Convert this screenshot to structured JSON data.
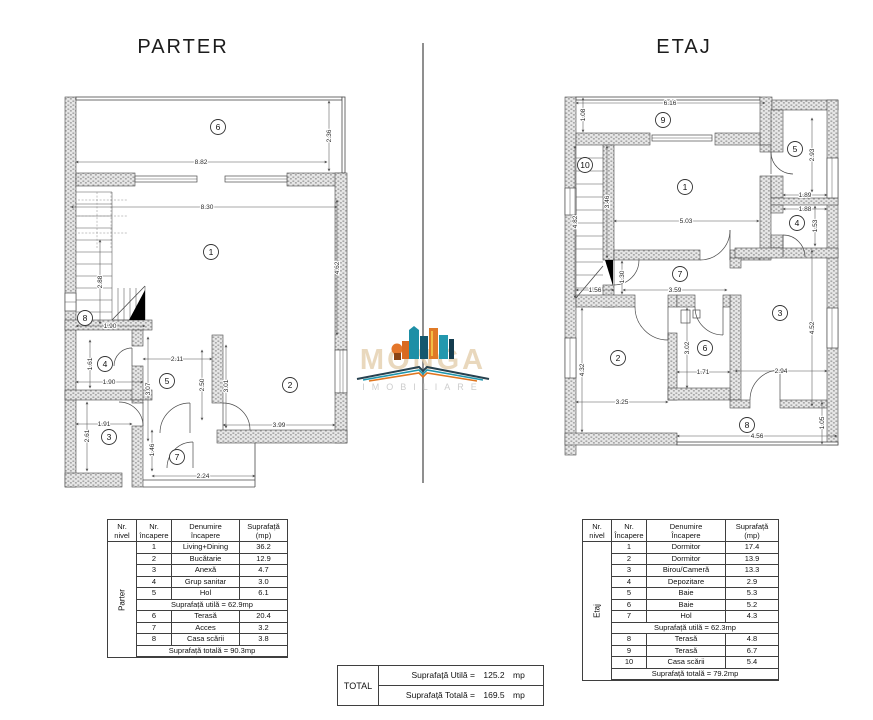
{
  "titles": {
    "left": "PARTER",
    "right": "ETAJ"
  },
  "watermark": {
    "name": "MONGA",
    "tagline": "IMOBILIARE"
  },
  "colors": {
    "accent_orange": "#e0751f",
    "accent_teal": "#1f96ad",
    "accent_navy": "#27414f",
    "wall_fill": "#e7e7e7",
    "wall_dot": "#9a9a9a",
    "line": "#4a4a4a",
    "divider": "#8f8f8f"
  },
  "plans": {
    "parter": {
      "rooms": [
        {
          "n": "6",
          "x": 161,
          "y": 39
        },
        {
          "n": "1",
          "x": 154,
          "y": 164
        },
        {
          "n": "8",
          "x": 28,
          "y": 230
        },
        {
          "n": "4",
          "x": 48,
          "y": 276
        },
        {
          "n": "5",
          "x": 110,
          "y": 293
        },
        {
          "n": "3",
          "x": 52,
          "y": 349
        },
        {
          "n": "7",
          "x": 120,
          "y": 369
        },
        {
          "n": "2",
          "x": 233,
          "y": 297
        }
      ],
      "dims": [
        {
          "v": "8.82",
          "x": 144,
          "y": 76
        },
        {
          "v": "2.36",
          "x": 274,
          "y": 48,
          "r": 1
        },
        {
          "v": "8.30",
          "x": 150,
          "y": 121
        },
        {
          "v": "4.62",
          "x": 282,
          "y": 180,
          "r": 1
        },
        {
          "v": "2.88",
          "x": 45,
          "y": 194,
          "r": 1
        },
        {
          "v": "1.90",
          "x": 53,
          "y": 240
        },
        {
          "v": "1.61",
          "x": 35,
          "y": 276,
          "r": 1
        },
        {
          "v": "1.90",
          "x": 52,
          "y": 296
        },
        {
          "v": "2.11",
          "x": 120,
          "y": 273
        },
        {
          "v": "3.07",
          "x": 93,
          "y": 301,
          "r": 1
        },
        {
          "v": "2.50",
          "x": 147,
          "y": 297,
          "r": 1
        },
        {
          "v": "1.91",
          "x": 47,
          "y": 338
        },
        {
          "v": "2.61",
          "x": 32,
          "y": 348,
          "r": 1
        },
        {
          "v": "1.46",
          "x": 97,
          "y": 362,
          "r": 1
        },
        {
          "v": "2.24",
          "x": 146,
          "y": 390
        },
        {
          "v": "3.99",
          "x": 222,
          "y": 339
        },
        {
          "v": "3.01",
          "x": 171,
          "y": 298,
          "r": 1
        }
      ]
    },
    "etaj": {
      "rooms": [
        {
          "n": "9",
          "x": 108,
          "y": 32
        },
        {
          "n": "10",
          "x": 30,
          "y": 77
        },
        {
          "n": "1",
          "x": 130,
          "y": 99
        },
        {
          "n": "5",
          "x": 240,
          "y": 61
        },
        {
          "n": "4",
          "x": 242,
          "y": 135
        },
        {
          "n": "7",
          "x": 125,
          "y": 186
        },
        {
          "n": "2",
          "x": 63,
          "y": 270
        },
        {
          "n": "6",
          "x": 150,
          "y": 260
        },
        {
          "n": "3",
          "x": 225,
          "y": 225
        },
        {
          "n": "8",
          "x": 192,
          "y": 337
        }
      ],
      "dims": [
        {
          "v": "6.16",
          "x": 115,
          "y": 17
        },
        {
          "v": "1.08",
          "x": 30,
          "y": 27,
          "r": 1
        },
        {
          "v": "4.82",
          "x": 22,
          "y": 134,
          "r": 1
        },
        {
          "v": "3.46",
          "x": 54,
          "y": 114,
          "r": 1
        },
        {
          "v": "5.03",
          "x": 131,
          "y": 135
        },
        {
          "v": "2.93",
          "x": 259,
          "y": 67,
          "r": 1
        },
        {
          "v": "1.89",
          "x": 250,
          "y": 109
        },
        {
          "v": "1.88",
          "x": 250,
          "y": 123
        },
        {
          "v": "1.53",
          "x": 262,
          "y": 138,
          "r": 1
        },
        {
          "v": "1.30",
          "x": 69,
          "y": 189,
          "r": 1
        },
        {
          "v": "1.56",
          "x": 40,
          "y": 204
        },
        {
          "v": "3.59",
          "x": 120,
          "y": 204
        },
        {
          "v": "4.32",
          "x": 29,
          "y": 282,
          "r": 1
        },
        {
          "v": "3.25",
          "x": 67,
          "y": 316
        },
        {
          "v": "3.02",
          "x": 134,
          "y": 260,
          "r": 1
        },
        {
          "v": "1.71",
          "x": 148,
          "y": 286
        },
        {
          "v": "2.94",
          "x": 226,
          "y": 285
        },
        {
          "v": "4.52",
          "x": 259,
          "y": 240,
          "r": 1
        },
        {
          "v": "4.56",
          "x": 202,
          "y": 350
        },
        {
          "v": "1.05",
          "x": 269,
          "y": 335,
          "r": 1
        }
      ]
    }
  },
  "tables": [
    {
      "id": "parter",
      "level_label": "Parter",
      "headers": [
        [
          "Nr.",
          "nivel"
        ],
        [
          "Nr.",
          "încapere"
        ],
        [
          "Denumire",
          "încapere"
        ],
        [
          "Suprafață",
          "(mp)"
        ]
      ],
      "rows": [
        {
          "nr": "1",
          "name": "Living+Dining",
          "area": "36.2"
        },
        {
          "nr": "2",
          "name": "Bucătarie",
          "area": "12.9"
        },
        {
          "nr": "3",
          "name": "Anexă",
          "area": "4.7"
        },
        {
          "nr": "4",
          "name": "Grup sanitar",
          "area": "3.0"
        },
        {
          "nr": "5",
          "name": "Hol",
          "area": "6.1"
        },
        {
          "merged": "Suprafață utilă = 62.9mp"
        },
        {
          "nr": "6",
          "name": "Terasă",
          "area": "20.4"
        },
        {
          "nr": "7",
          "name": "Acces",
          "area": "3.2"
        },
        {
          "nr": "8",
          "name": "Casa scării",
          "area": "3.8"
        },
        {
          "merged": "Suprafață totală = 90.3mp"
        }
      ]
    },
    {
      "id": "etaj",
      "level_label": "Etaj",
      "headers": [
        [
          "Nr.",
          "nivel"
        ],
        [
          "Nr.",
          "Încapere"
        ],
        [
          "Denumire",
          "Încapere"
        ],
        [
          "Suprafață",
          "(mp)"
        ]
      ],
      "rows": [
        {
          "nr": "1",
          "name": "Dormitor",
          "area": "17.4"
        },
        {
          "nr": "2",
          "name": "Dormitor",
          "area": "13.9"
        },
        {
          "nr": "3",
          "name": "Birou/Cameră",
          "area": "13.3"
        },
        {
          "nr": "4",
          "name": "Depozitare",
          "area": "2.9"
        },
        {
          "nr": "5",
          "name": "Baie",
          "area": "5.3"
        },
        {
          "nr": "6",
          "name": "Baie",
          "area": "5.2"
        },
        {
          "nr": "7",
          "name": "Hol",
          "area": "4.3"
        },
        {
          "merged": "Suprafață utilă = 62.3mp"
        },
        {
          "nr": "8",
          "name": "Terasă",
          "area": "4.8"
        },
        {
          "nr": "9",
          "name": "Terasă",
          "area": "6.7"
        },
        {
          "nr": "10",
          "name": "Casa scării",
          "area": "5.4"
        },
        {
          "merged": "Suprafață totală = 79.2mp"
        }
      ]
    }
  ],
  "total_table": {
    "label": "TOTAL",
    "rows": [
      {
        "label": "Suprafață Utilă =",
        "value": "125.2",
        "unit": "mp"
      },
      {
        "label": "Suprafață Totală =",
        "value": "169.5",
        "unit": "mp"
      }
    ]
  }
}
